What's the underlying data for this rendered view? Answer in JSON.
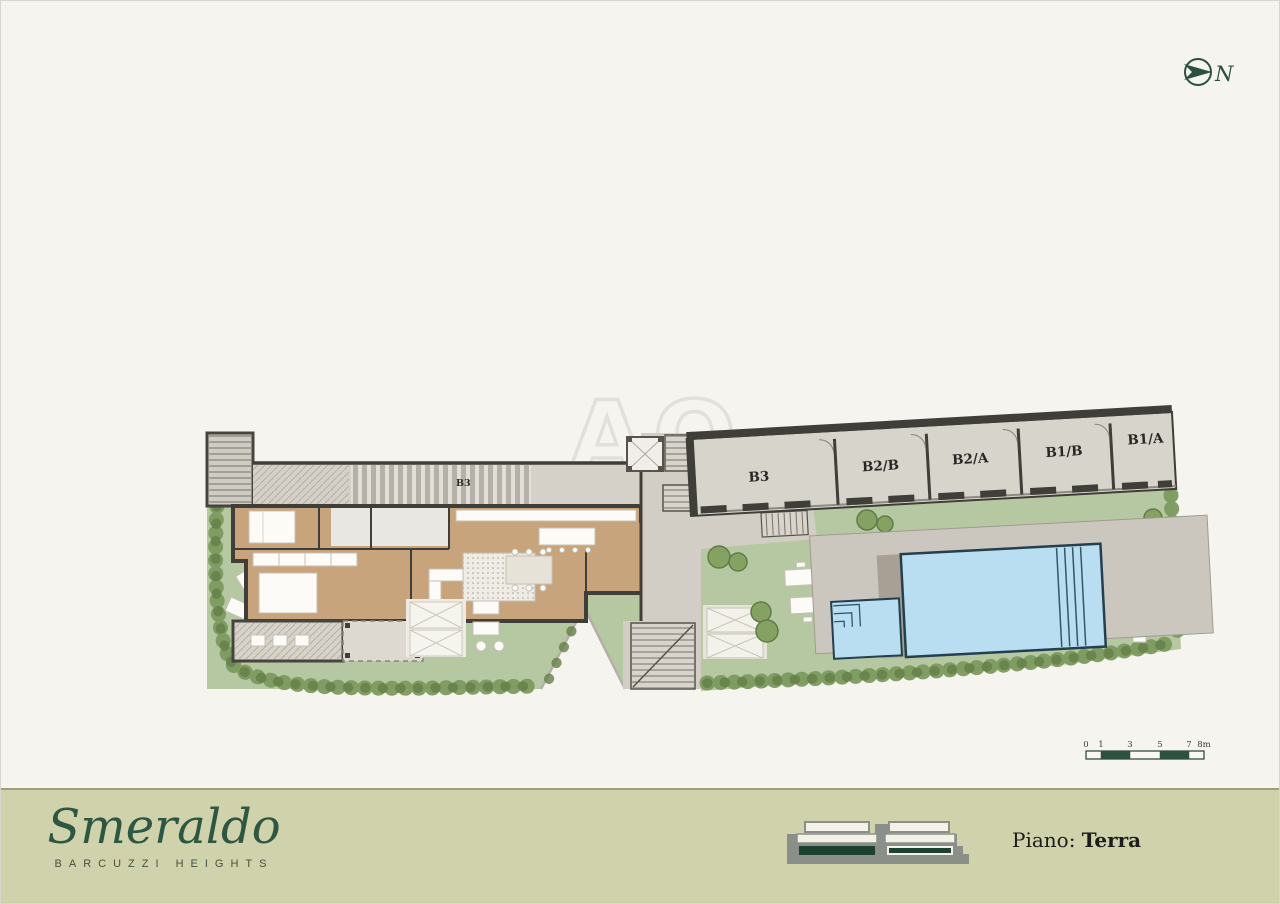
{
  "header": {
    "north_label": "N"
  },
  "watermark": {
    "text": "AO"
  },
  "plan": {
    "apartment_unit_label": "B3",
    "garage_units": [
      {
        "label": "B3"
      },
      {
        "label": "B2/B"
      },
      {
        "label": "B2/A"
      },
      {
        "label": "B1/B"
      },
      {
        "label": "B1/A"
      }
    ]
  },
  "scale_bar": {
    "ticks": [
      "0",
      "1",
      "3",
      "5",
      "7",
      "8m"
    ]
  },
  "footer": {
    "brand": "Smeraldo",
    "tagline": "BARCUZZI HEIGHTS",
    "floor_label": "Piano:",
    "floor_value": "Terra"
  },
  "colors": {
    "brand_green": "#2c5140",
    "footer_band": "#cfd2ab",
    "lawn_green": "#b6c8a1",
    "pool_blue": "#b9ddf1",
    "wall_dark": "#3f3e39",
    "wood_floor": "#c8a47c"
  }
}
